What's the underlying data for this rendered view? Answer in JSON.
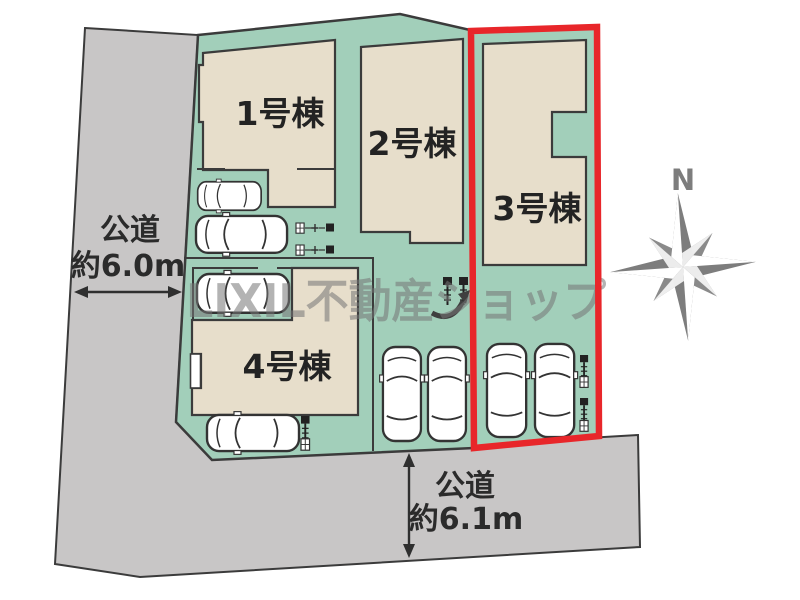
{
  "site_plan": {
    "watermark_text": "LIXIL不動産ショップ",
    "compass_north": "N",
    "highlighted_building": "3号棟",
    "buildings": [
      {
        "label": "1号棟"
      },
      {
        "label": "2号棟"
      },
      {
        "label": "3号棟"
      },
      {
        "label": "4号棟"
      }
    ],
    "roads": [
      {
        "label": "公道",
        "width": "約6.0m",
        "position": "west"
      },
      {
        "label": "公道",
        "width": "約6.1m",
        "position": "south"
      }
    ],
    "parking": {
      "car_count": 8
    },
    "colors": {
      "site_green": "#a2cfba",
      "building_fill": "#e7decb",
      "road_gray": "#c8c6c6",
      "outline": "#3b3b3b",
      "highlight_red": "#e8262a",
      "compass_gray": "#7d7d7d",
      "watermark_gray": "#767676"
    }
  }
}
